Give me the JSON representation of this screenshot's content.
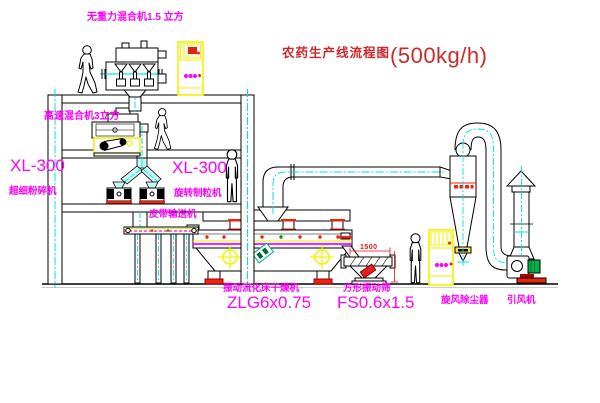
{
  "title": {
    "zh": "农药生产线流程图",
    "capacity": "(500kg/h)"
  },
  "labels": {
    "gravity_mixer": "无重力混合机1.5 立方",
    "high_speed_mixer": "高速混合机3立方",
    "xl300_left": "XL-300",
    "pulverizer": "超细粉碎机",
    "xl300_mid": "XL-300",
    "granulator": "旋转制粒机",
    "belt_conveyor": "皮带输送机",
    "dryer_name": "振动流化床干燥机",
    "dryer_model": "ZLG6x0.75",
    "screen_name": "方形振动筛",
    "screen_model": "FS0.6x1.5",
    "cyclone": "旋风除尘器",
    "fan": "引风机"
  },
  "dimensions": {
    "screen_length": "1500"
  },
  "colors": {
    "magenta": "#ff00ff",
    "cyan": "#00e2e2",
    "yellow": "#f2f200",
    "red": "#ee1111",
    "title_red": "#cc2a2a",
    "green": "#00b34d"
  }
}
